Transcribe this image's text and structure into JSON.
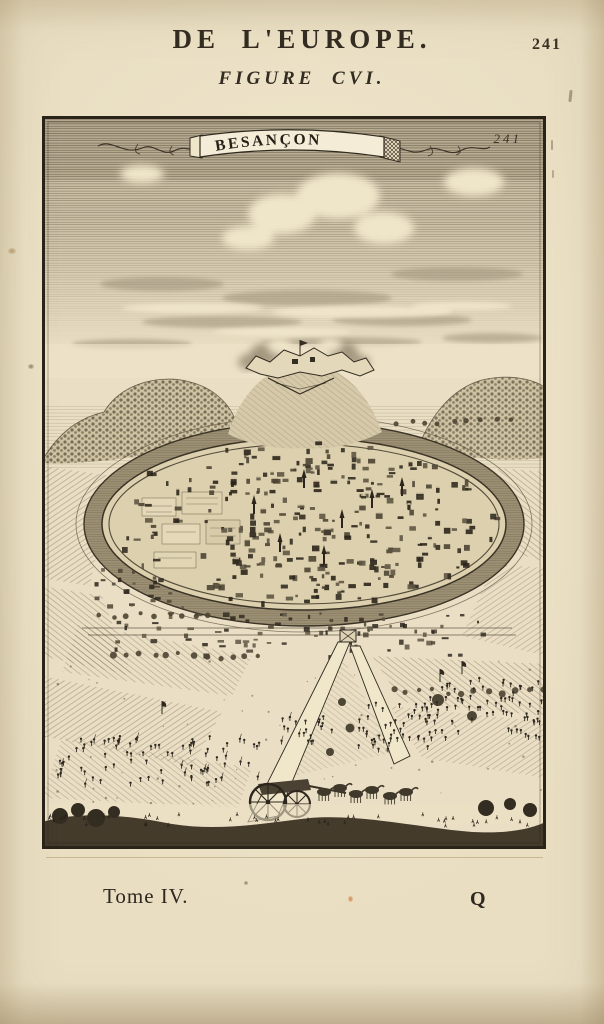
{
  "header": {
    "title": "DE L'EUROPE.",
    "page_number": "241",
    "figure_label": "FIGURE CVI."
  },
  "plate": {
    "banner_title": "BESANÇON",
    "plate_number": "241"
  },
  "footer": {
    "tome_label": "Tome IV.",
    "signature_letter": "Q"
  },
  "colors": {
    "paper": "#e9dec2",
    "ink": "#2e2820",
    "engraving_line": "#6a5e48",
    "ribbon": "#f4ecd6",
    "foxing": "#96693c"
  }
}
